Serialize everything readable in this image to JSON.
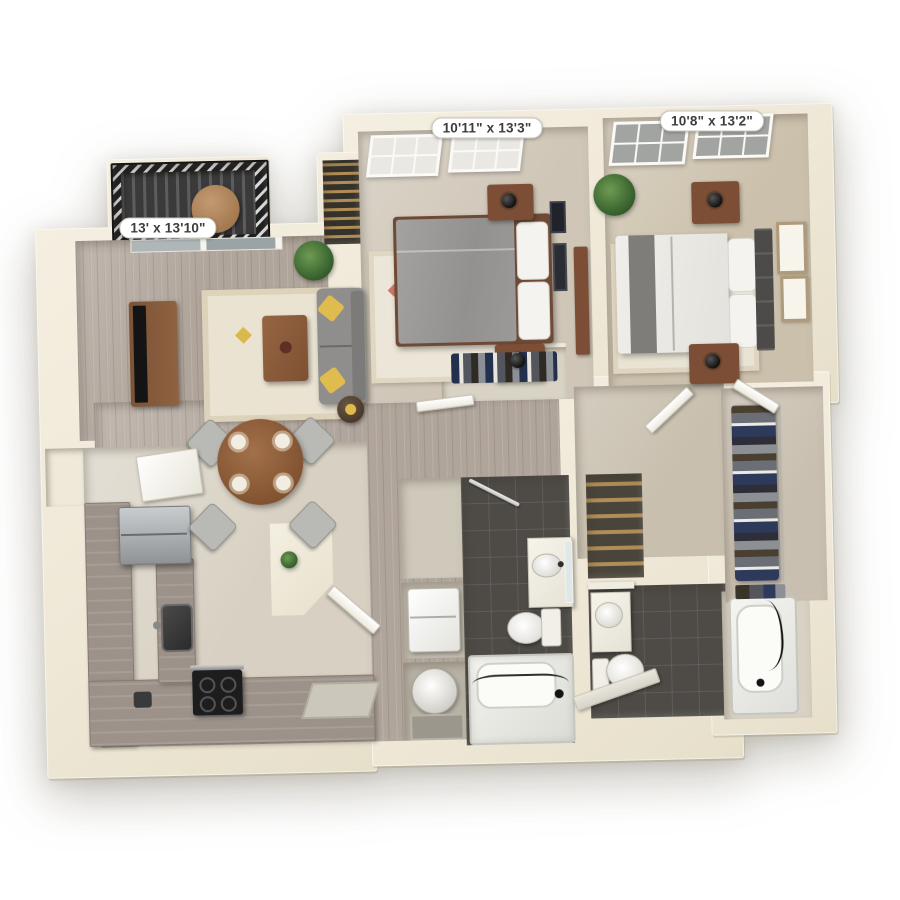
{
  "floor_plan": {
    "type": "3d-top-down-apartment-floor-plan",
    "background_color": "#ffffff",
    "labels": {
      "bedroom1": "10'11\" x 13'3\"",
      "bedroom2": "10'8\" x 13'2\"",
      "living_room": "13' x 13'10\""
    },
    "colors": {
      "wall": "#f0e9d8",
      "wood_floor": "#b0a59b",
      "kitchen_floor": "#d8d1c3",
      "carpet_bedroom1": "#cfc6b7",
      "carpet_bedroom2": "#cbc0ab",
      "bathroom_tile": "#4e4b47",
      "balcony_deck": "#3a3a3a",
      "cabinet_wood": "#9c928a",
      "sofa_gray": "#8f8e8c",
      "accent_pillow_yellow": "#e0bc4e",
      "furniture_wood_brown": "#8a5a3b",
      "label_text": "#3e3d3b",
      "label_background": "#ffffff"
    },
    "rooms": [
      {
        "name": "living-room",
        "dimensions": "13' x 13'10\"",
        "furniture": [
          "tv-console",
          "tv",
          "sofa",
          "yellow-pillows",
          "coffee-table",
          "area-rug",
          "plant",
          "side-table",
          "sliding-glass-door"
        ]
      },
      {
        "name": "balcony",
        "furniture": [
          "railing",
          "deck",
          "round-table"
        ]
      },
      {
        "name": "bedroom-1",
        "dimensions": "10'11\" x 13'3\"",
        "furniture": [
          "bed",
          "pillows",
          "nightstand-with-lamp",
          "nightstand-with-lamp",
          "area-rug",
          "windows",
          "wall-art",
          "closet-with-clothes"
        ]
      },
      {
        "name": "bedroom-2",
        "dimensions": "10'8\" x 13'2\"",
        "furniture": [
          "bed",
          "gray-throw",
          "headboard",
          "pillows",
          "nightstand-with-lamp",
          "nightstand-with-lamp",
          "area-rug",
          "windows",
          "wall-art",
          "dresser",
          "plant"
        ]
      },
      {
        "name": "kitchen",
        "furniture": [
          "l-shaped-counter",
          "island-counter",
          "refrigerator",
          "stove",
          "sink",
          "toaster",
          "cabinet",
          "pantry-nook",
          "breakfast-bar",
          "plant"
        ]
      },
      {
        "name": "dining-area",
        "furniture": [
          "round-table",
          "chairs",
          "place-settings"
        ]
      },
      {
        "name": "bathroom-1",
        "furniture": [
          "vanity-sink",
          "mirror",
          "toilet",
          "bathtub",
          "shower-rod",
          "towel-bar"
        ]
      },
      {
        "name": "bathroom-2",
        "furniture": [
          "vanity-sink",
          "toilet",
          "bathtub",
          "hand-shower"
        ]
      },
      {
        "name": "walk-in-closet",
        "furniture": [
          "hanging-clothes",
          "shelf"
        ]
      },
      {
        "name": "utility-closets",
        "furniture": [
          "washer",
          "water-heater",
          "drain-pan"
        ]
      },
      {
        "name": "linen-closet",
        "furniture": [
          "shelves"
        ]
      },
      {
        "name": "hall-closet",
        "furniture": [
          "wire-shelves"
        ]
      },
      {
        "name": "entry",
        "furniture": [
          "front-door",
          "door-mat"
        ]
      }
    ]
  }
}
